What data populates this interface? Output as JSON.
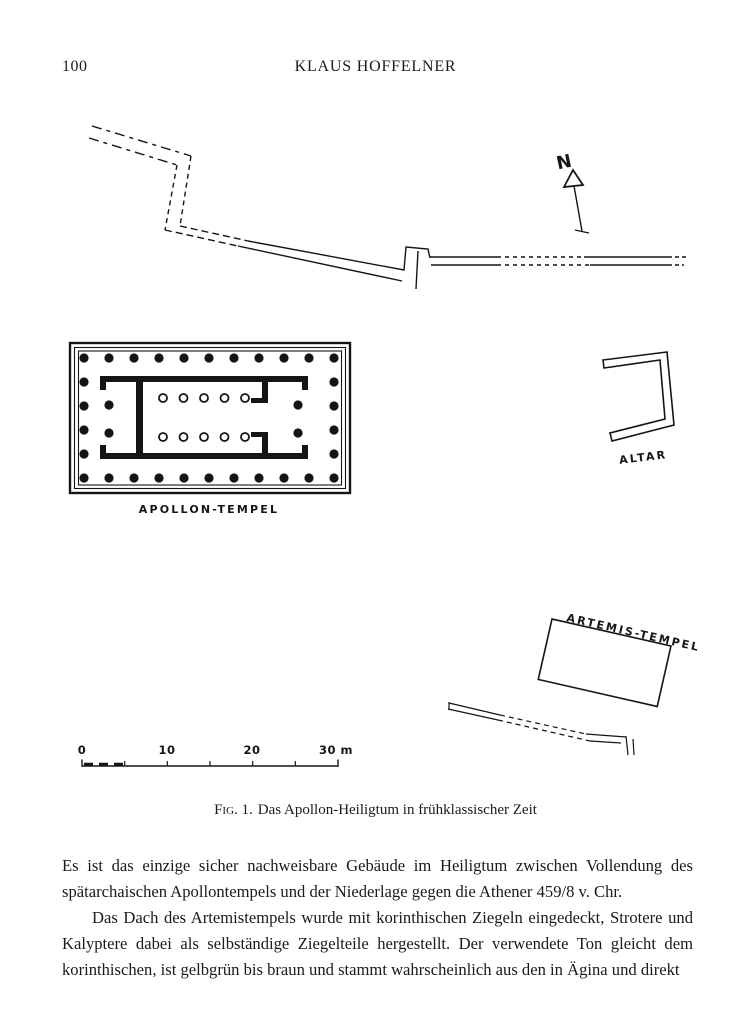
{
  "page": {
    "number": "100",
    "running_head": "KLAUS HOFFELNER"
  },
  "figure": {
    "north_label": "N",
    "apollon_label": "APOLLON-TEMPEL",
    "altar_label": "ALTAR",
    "artemis_label": "ARTEMIS-TEMPEL",
    "scale_labels": [
      "0",
      "10",
      "20",
      "30 m"
    ],
    "caption_prefix": "Fig. 1.",
    "caption_text": "Das Apollon-Heiligtum in frühklassischer Zeit"
  },
  "body": {
    "para1": "Es ist das einzige sicher nachweisbare Gebäude im Heiligtum zwischen Vollendung des spätarchaischen Apollontempels und der Niederlage gegen die Athener 459/8 v. Chr.",
    "para2": "Das Dach des Artemistempels wurde mit korinthischen Ziegeln eingedeckt, Strotere und Kalyptere dabei als selbständige Ziegelteile hergestellt.  Der verwendete Ton gleicht dem korinthischen, ist gelbgrün bis braun und stammt wahrscheinlich aus den in Ägina und direkt"
  },
  "colors": {
    "ink": "#151515",
    "paper": "#ffffff"
  }
}
